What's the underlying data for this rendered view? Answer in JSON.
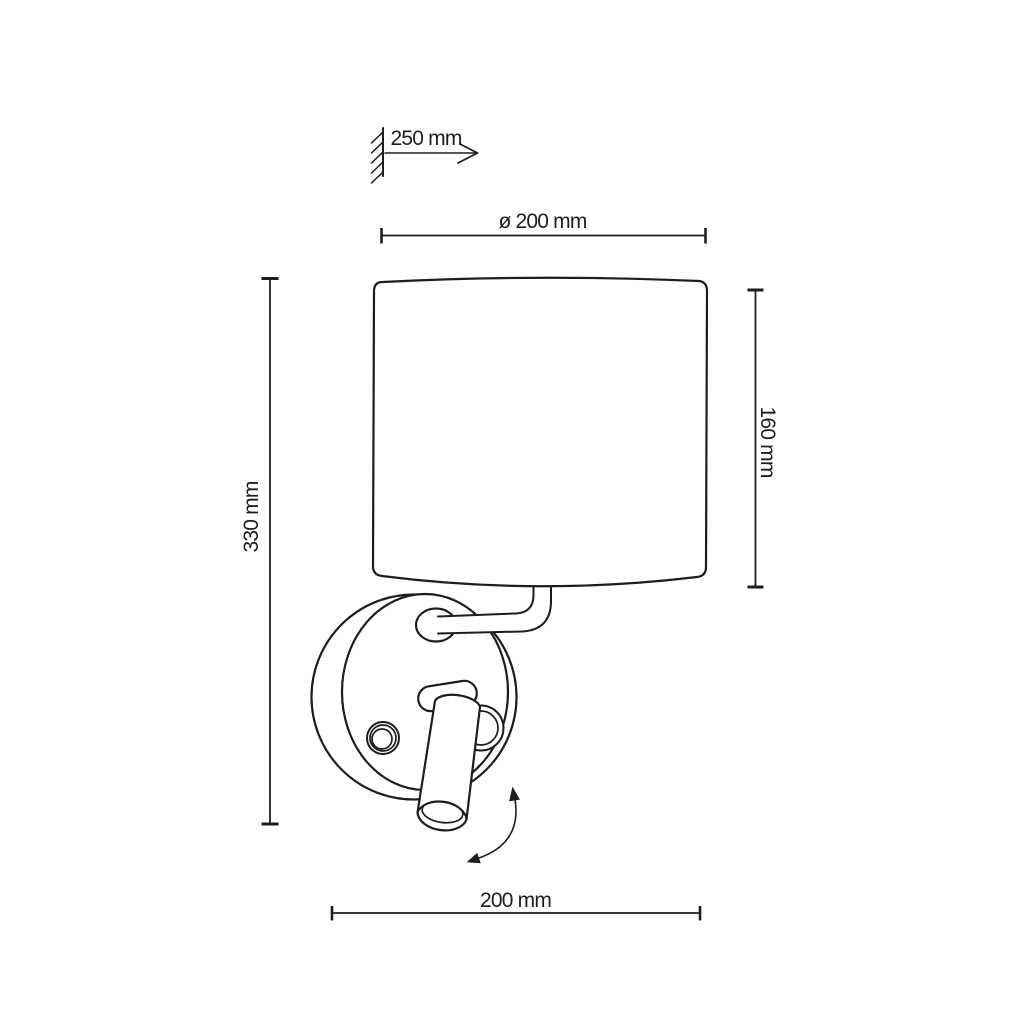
{
  "figure": {
    "subject": "wall-lamp-dimension-drawing",
    "line_color": "#1d1d1b",
    "background_color": "#ffffff",
    "parts": [
      "wall-mount-symbol",
      "lampshade",
      "wall-plate",
      "switch-button",
      "curved-arm",
      "arm-flange",
      "pivot-bracket",
      "pivot-ring",
      "reading-spotlight",
      "rotation-arrow"
    ]
  },
  "dimensions": {
    "wall_offset": "250 mm",
    "shade_diameter": "ø 200 mm",
    "overall_height": "330 mm",
    "shade_height": "160 mm",
    "overall_width": "200 mm"
  }
}
